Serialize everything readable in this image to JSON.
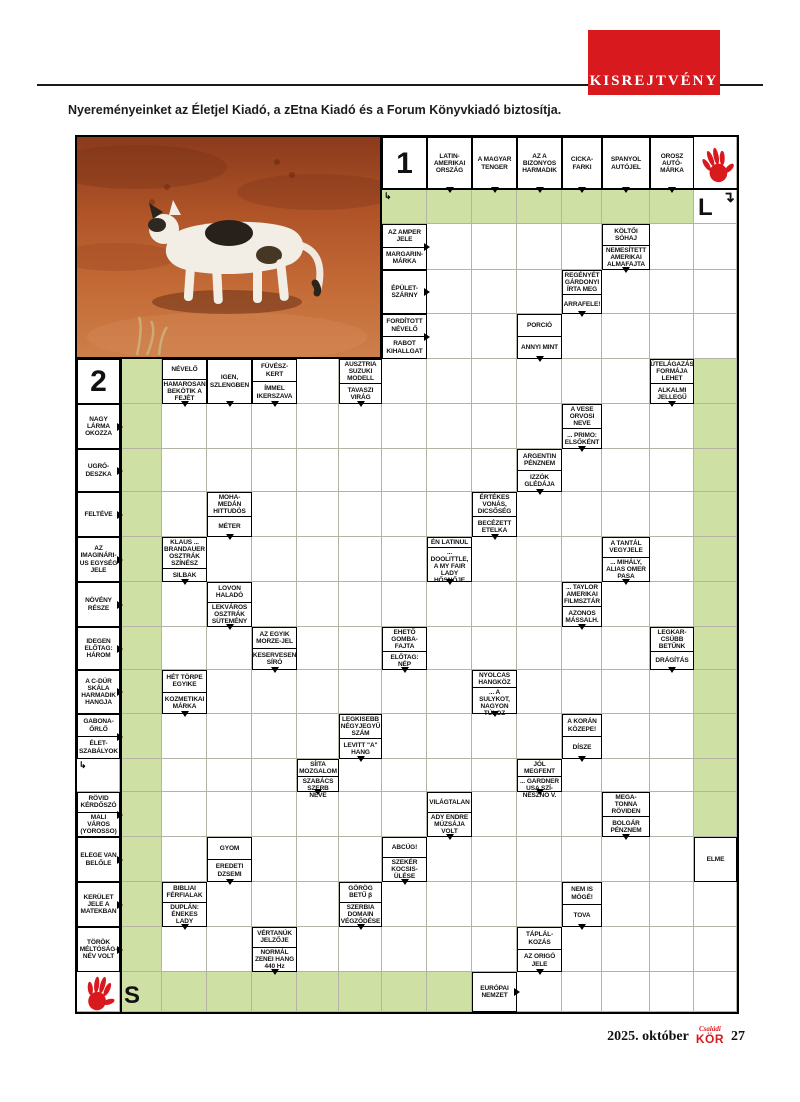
{
  "banner": {
    "label": "KISREJTVÉNY"
  },
  "intro": "Nyereményeinket az Életjel Kiadó, a zEtna Kiadó és a Forum Könyvkiadó biztosítja.",
  "footer": {
    "date": "2025. október",
    "magazine_top": "Családi",
    "magazine": "KÖR",
    "page": "27"
  },
  "colors": {
    "accent_red": "#d8191e",
    "grid_green": "#cfe0a5"
  },
  "grid": {
    "cols": [
      75,
      118,
      160,
      205,
      250,
      295,
      337,
      380,
      425,
      470,
      515,
      560,
      600,
      648,
      692,
      735
    ],
    "rows": [
      135,
      188,
      222,
      268,
      312,
      357,
      402,
      447,
      490,
      535,
      580,
      625,
      668,
      712,
      757,
      790,
      835,
      880,
      925,
      970,
      1010
    ],
    "photo": {
      "name": "cat-in-desert-photo"
    },
    "numbers": [
      {
        "label": "1",
        "c": 7,
        "r": 0
      },
      {
        "label": "2",
        "c": 0,
        "r": 5
      }
    ],
    "letters": [
      {
        "label": "L",
        "c": 14,
        "r": 1,
        "arrow": "↴"
      },
      {
        "label": "S",
        "c": 1,
        "r": 19,
        "arrow": ""
      }
    ],
    "hands": [
      {
        "c": 14,
        "r": 0,
        "rot": -15
      },
      {
        "c": 0,
        "r": 19,
        "rot": 12
      }
    ],
    "start_arrows": [
      {
        "c": 7,
        "r": 1,
        "glyph": "↳"
      },
      {
        "c": 0,
        "r": 14,
        "glyph": "↳"
      }
    ],
    "green": [
      [
        7,
        1,
        14,
        2
      ],
      [
        1,
        5,
        2,
        20
      ],
      [
        14,
        5,
        15,
        16
      ],
      [
        2,
        19,
        9,
        20
      ]
    ],
    "clues": [
      {
        "c": 8,
        "r": 0,
        "parts": [
          "LATIN-AMERIKAI ORSZÁG"
        ],
        "a": "d"
      },
      {
        "c": 9,
        "r": 0,
        "parts": [
          "A MAGYAR TENGER"
        ],
        "a": "d"
      },
      {
        "c": 10,
        "r": 0,
        "parts": [
          "AZ A BIZONYOS HARMADIK"
        ],
        "a": "d"
      },
      {
        "c": 11,
        "r": 0,
        "parts": [
          "CICKA-FARKI"
        ],
        "a": "d"
      },
      {
        "c": 12,
        "r": 0,
        "parts": [
          "SPANYOL AUTÓJEL"
        ],
        "a": "d"
      },
      {
        "c": 13,
        "r": 0,
        "parts": [
          "OROSZ AUTÓ-MÁRKA"
        ],
        "a": "d"
      },
      {
        "c": 7,
        "r": 2,
        "parts": [
          "AZ AMPER JELE",
          "MARGARIN-MÁRKA"
        ],
        "a": "r"
      },
      {
        "c": 12,
        "r": 2,
        "parts": [
          "KÖLTŐI SÓHAJ",
          "NEMESÍTETT AMERIKAI ALMAFAJTA"
        ],
        "a": "d"
      },
      {
        "c": 7,
        "r": 3,
        "parts": [
          "ÉPÜLET-SZÁRNY"
        ],
        "a": "r"
      },
      {
        "c": 11,
        "r": 3,
        "parts": [
          "REGÉNYÉT GÁRDONYI ÍRTA MEG",
          "ARRAFELE!"
        ],
        "a": "d"
      },
      {
        "c": 7,
        "r": 4,
        "parts": [
          "FORDÍTOTT NÉVELŐ",
          "RABOT KIHALLGAT"
        ],
        "a": "r"
      },
      {
        "c": 10,
        "r": 4,
        "parts": [
          "PORCIÓ",
          "ANNYI MINT"
        ],
        "a": "d"
      },
      {
        "c": 2,
        "r": 5,
        "parts": [
          "NÉVELŐ",
          "HAMAROSAN BEKÖTIK A FEJÉT"
        ],
        "a": "d"
      },
      {
        "c": 3,
        "r": 5,
        "parts": [
          "IGEN, SZLENGBEN"
        ],
        "a": "d"
      },
      {
        "c": 4,
        "r": 5,
        "parts": [
          "FÜVÉSZ-KERT",
          "ÍMMEL IKERSZAVA"
        ],
        "a": "d"
      },
      {
        "c": 6,
        "r": 5,
        "parts": [
          "AUSZTRIA SUZUKI MODELL",
          "TAVASZI VIRÁG"
        ],
        "a": "d"
      },
      {
        "c": 13,
        "r": 5,
        "parts": [
          "ÚTELÁGAZÁS FORMÁJA LEHET",
          "ALKALMI JELLEGŰ"
        ],
        "a": "d"
      },
      {
        "c": 0,
        "r": 6,
        "parts": [
          "NAGY LÁRMA OKOZZA"
        ],
        "a": "r"
      },
      {
        "c": 11,
        "r": 6,
        "parts": [
          "A VESE ORVOSI NEVE",
          "... PRIMO: ELSŐKÉNT"
        ],
        "a": "d"
      },
      {
        "c": 0,
        "r": 7,
        "parts": [
          "UGRÓ-DESZKA"
        ],
        "a": "r"
      },
      {
        "c": 10,
        "r": 7,
        "parts": [
          "ARGENTIN PÉNZNEM",
          "IZZÓK GLÉDÁJA"
        ],
        "a": "d"
      },
      {
        "c": 0,
        "r": 8,
        "parts": [
          "FELTÉVE"
        ],
        "a": "r"
      },
      {
        "c": 3,
        "r": 8,
        "parts": [
          "MOHA-MEDÁN HITTUDÓS",
          "MÉTER"
        ],
        "a": "d"
      },
      {
        "c": 9,
        "r": 8,
        "parts": [
          "ÉRTÉKES VONÁS, DICSŐSÉG",
          "BECÉZETT ETELKA"
        ],
        "a": "d"
      },
      {
        "c": 0,
        "r": 9,
        "parts": [
          "AZ IMAGINÁRI- US EGYSÉG JELE"
        ],
        "a": "r"
      },
      {
        "c": 2,
        "r": 9,
        "parts": [
          "KLAUS ... BRANDAUER OSZTRÁK SZÍNÉSZ",
          "SILBAK"
        ],
        "a": "d"
      },
      {
        "c": 8,
        "r": 9,
        "parts": [
          "ÉN LATINUL",
          "... DOOLITTLE, A MY FAIR LADY HŐSNŐJE"
        ],
        "a": "d"
      },
      {
        "c": 12,
        "r": 9,
        "parts": [
          "A TANTÁL VEGYJELE",
          "... MIHÁLY, ALIAS OMER PASA"
        ],
        "a": "d"
      },
      {
        "c": 0,
        "r": 10,
        "parts": [
          "NÖVÉNY RÉSZE"
        ],
        "a": "r"
      },
      {
        "c": 3,
        "r": 10,
        "parts": [
          "LOVON HALADÓ",
          "LEKVÁROS OSZTRÁK SÜTEMÉNY"
        ],
        "a": "d"
      },
      {
        "c": 11,
        "r": 10,
        "parts": [
          "... TAYLOR AMERIKAI FILMSZTÁR",
          "AZONOS MÁSSALH."
        ],
        "a": "d"
      },
      {
        "c": 0,
        "r": 11,
        "parts": [
          "IDEGEN ELŐTAG: HÁROM"
        ],
        "a": "r"
      },
      {
        "c": 4,
        "r": 11,
        "parts": [
          "AZ EGYIK MORZE-JEL",
          "KESERVESEN SÍRÓ"
        ],
        "a": "d"
      },
      {
        "c": 7,
        "r": 11,
        "parts": [
          "EHETŐ GOMBA-FAJTA",
          "ELŐTAG: NÉP"
        ],
        "a": "d"
      },
      {
        "c": 13,
        "r": 11,
        "parts": [
          "LEGKAR- CSÚBB BETŰNK",
          "DRÁGÍTÁS"
        ],
        "a": "d"
      },
      {
        "c": 0,
        "r": 12,
        "parts": [
          "A C-DÚR SKÁLA HARMADIK HANGJA"
        ],
        "a": "r"
      },
      {
        "c": 2,
        "r": 12,
        "parts": [
          "HÉT TÖRPE EGYIKE",
          "KOZMETIKAI MÁRKA"
        ],
        "a": "d"
      },
      {
        "c": 9,
        "r": 12,
        "parts": [
          "NYOLCAS HANGKÖZ",
          "... A SULYKOT, NAGYON TÚLOZ"
        ],
        "a": "d"
      },
      {
        "c": 0,
        "r": 13,
        "parts": [
          "GABONA-ŐRLŐ",
          "ÉLET-SZABÁLYOK"
        ],
        "a": "r"
      },
      {
        "c": 6,
        "r": 13,
        "parts": [
          "LEGKISEBB NÉGYJEGYŰ SZÁM",
          "LEVITT \"A\" HANG"
        ],
        "a": "d"
      },
      {
        "c": 11,
        "r": 13,
        "parts": [
          "A KORÁN KÖZEPE!",
          "DÍSZE"
        ],
        "a": "d"
      },
      {
        "c": 5,
        "r": 14,
        "parts": [
          "SÍITA MOZGALOM",
          "SZABÁCS SZERB NEVE"
        ],
        "a": "d"
      },
      {
        "c": 10,
        "r": 14,
        "parts": [
          "JÓL MEGFENT",
          "... GARDNER USA SZÍ- NÉSZNŐ V."
        ],
        "a": "d"
      },
      {
        "c": 0,
        "r": 15,
        "parts": [
          "RÖVID KÉRDŐSZÓ",
          "MALI VÁROS (YOROSSO)"
        ],
        "a": "r"
      },
      {
        "c": 8,
        "r": 15,
        "parts": [
          "VILÁGTALAN",
          "ADY ENDRE MÚZSÁJA VOLT"
        ],
        "a": "d"
      },
      {
        "c": 12,
        "r": 15,
        "parts": [
          "MEGA- TONNA RÖVIDEN",
          "BOLGÁR PÉNZNEM"
        ],
        "a": "d"
      },
      {
        "c": 0,
        "r": 16,
        "parts": [
          "ELEGE VAN BELŐLE"
        ],
        "a": "r"
      },
      {
        "c": 3,
        "r": 16,
        "parts": [
          "GYOM",
          "EREDETI DZSEMI"
        ],
        "a": "d"
      },
      {
        "c": 7,
        "r": 16,
        "parts": [
          "ABCÚG!",
          "SZEKÉR KOCSIS-ÜLÉSE"
        ],
        "a": "d"
      },
      {
        "c": 14,
        "r": 16,
        "parts": [
          "ELME"
        ],
        "a": null
      },
      {
        "c": 0,
        "r": 17,
        "parts": [
          "KERÜLET JELE A MATEKBAN"
        ],
        "a": "r"
      },
      {
        "c": 2,
        "r": 17,
        "parts": [
          "BIBLIAI FÉRFIALAK",
          "DUPLÁN: ÉNEKES LADY"
        ],
        "a": "d"
      },
      {
        "c": 6,
        "r": 17,
        "parts": [
          "GÖRÖG BETŰ β",
          "SZERBIA DOMAIN VÉGZŐDÉSE"
        ],
        "a": "d"
      },
      {
        "c": 11,
        "r": 17,
        "parts": [
          "NEM IS MÖGÉ!",
          "TOVA"
        ],
        "a": "d"
      },
      {
        "c": 0,
        "r": 18,
        "parts": [
          "TÖRÖK MÉLTÓSÁG- NÉV VOLT"
        ],
        "a": "r"
      },
      {
        "c": 4,
        "r": 18,
        "parts": [
          "VÉRTANÚK JELZŐJE",
          "NORMÁL ZENEI HANG 440 Hz"
        ],
        "a": "d"
      },
      {
        "c": 10,
        "r": 18,
        "parts": [
          "TÁPLÁL- KOZÁS",
          "AZ ORIGÓ JELE"
        ],
        "a": "d"
      },
      {
        "c": 9,
        "r": 19,
        "parts": [
          "EURÓPAI NEMZET"
        ],
        "a": "r"
      }
    ]
  }
}
